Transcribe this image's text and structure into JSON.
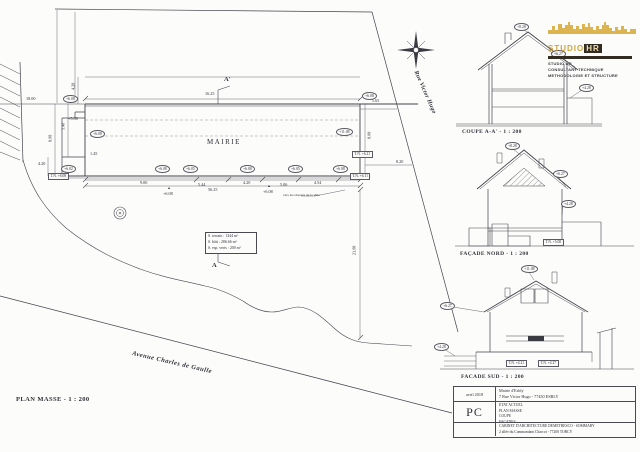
{
  "sheet": {
    "colors": {
      "paper": "#fcfcfa",
      "line": "#44444e",
      "logo_gold": "#d0a23c",
      "logo_dark": "#332c23"
    }
  },
  "titles": {
    "plan_masse": "PLAN MASSE - 1 : 200",
    "coupe": "COUPE A-A' - 1 : 200",
    "facade_nord": "FAÇADE NORD - 1 : 200",
    "facade_sud": "FACADE SUD - 1 : 200"
  },
  "plan": {
    "building_label": "MAIRIE",
    "surface_box": {
      "line1": "S. terrain : 1344 m²",
      "line2": "S. bâti : 286.66 m²",
      "line3": "S. esp. verts : 200 m²"
    }
  },
  "logo": {
    "brand_studio": "STUDIO",
    "brand_hr": "HR",
    "tagline1": "STUDIO HR",
    "tagline2": "CONSULTANT TECHNIQUE",
    "tagline3": "METHODOLOGIE ET STRUCTURE"
  },
  "titleblock": {
    "date": "avril 2018",
    "doc_type": "PC",
    "client_name": "Mairie d'Esbly",
    "client_address": "7 Rue Victor Hugo - 77450 ESBLY",
    "content1": "ETAT ACTUEL",
    "content2": "PLAN MASSE",
    "content3": "COUPE",
    "content4": "FACADES",
    "architect": "CABINET D'ARCHITECTURE DEMETRESCO - SOMMARY",
    "architect_address": "2 allée du Commandant Charcot - 77200 TORCY"
  },
  "annotations": [
    {
      "t": "16.25",
      "x": 205,
      "y": 92,
      "c": "dim",
      "n": "dim-label"
    },
    {
      "t": "56.25",
      "x": 208,
      "y": 188,
      "c": "dim",
      "n": "dim-label"
    },
    {
      "t": "18.00",
      "x": 26,
      "y": 97,
      "c": "dim",
      "n": "dim-label"
    },
    {
      "t": "4.28",
      "x": 70,
      "y": 84,
      "c": "dim rot90",
      "n": "dim-label"
    },
    {
      "t": "5.40",
      "x": 60,
      "y": 124,
      "c": "dim rot90",
      "n": "dim-label"
    },
    {
      "t": "8.08",
      "x": 47,
      "y": 136,
      "c": "dim rot90",
      "n": "dim-label"
    },
    {
      "t": "4.20",
      "x": 38,
      "y": 162,
      "c": "dim",
      "n": "dim-label"
    },
    {
      "t": "1.45",
      "x": 90,
      "y": 152,
      "c": "dim",
      "n": "dim-label"
    },
    {
      "t": "9.00",
      "x": 140,
      "y": 181,
      "c": "dim",
      "n": "dim-label"
    },
    {
      "t": "5.44",
      "x": 198,
      "y": 183,
      "c": "dim",
      "n": "dim-label"
    },
    {
      "t": "4.20",
      "x": 243,
      "y": 181,
      "c": "dim",
      "n": "dim-label"
    },
    {
      "t": "5.06",
      "x": 280,
      "y": 183,
      "c": "dim",
      "n": "dim-label"
    },
    {
      "t": "4.54",
      "x": 314,
      "y": 181,
      "c": "dim",
      "n": "dim-label"
    },
    {
      "t": "5.65",
      "x": 372,
      "y": 99,
      "c": "dim",
      "n": "dim-label"
    },
    {
      "t": "8.08",
      "x": 366,
      "y": 133,
      "c": "dim rot90",
      "n": "dim-label"
    },
    {
      "t": "8.20",
      "x": 396,
      "y": 160,
      "c": "dim",
      "n": "dim-label"
    },
    {
      "t": "21.08",
      "x": 350,
      "y": 248,
      "c": "dim rot90",
      "n": "dim-label"
    },
    {
      "t": "+5.08",
      "x": 68,
      "y": 117,
      "c": "dim",
      "n": "level-label"
    },
    {
      "t": "+6.08",
      "x": 163,
      "y": 192,
      "c": "dim",
      "n": "level-label"
    },
    {
      "t": "+6.08",
      "x": 263,
      "y": 190,
      "c": "dim",
      "n": "level-label"
    },
    {
      "t": "▴",
      "x": 168,
      "y": 186,
      "c": "dim",
      "n": "threshold-marker"
    },
    {
      "t": "▴",
      "x": 268,
      "y": 184,
      "c": "dim",
      "n": "threshold-marker"
    },
    {
      "t": "+6.08",
      "x": 63,
      "y": 95,
      "c": "bub",
      "n": "level-bubble"
    },
    {
      "t": "+6.08",
      "x": 90,
      "y": 130,
      "c": "bub",
      "n": "level-bubble"
    },
    {
      "t": "+6.02",
      "x": 61,
      "y": 165,
      "c": "bub",
      "n": "level-bubble"
    },
    {
      "t": "+6.08",
      "x": 155,
      "y": 165,
      "c": "bub",
      "n": "level-bubble"
    },
    {
      "t": "+6.05",
      "x": 183,
      "y": 165,
      "c": "bub",
      "n": "level-bubble"
    },
    {
      "t": "+6.08",
      "x": 240,
      "y": 165,
      "c": "bub",
      "n": "level-bubble"
    },
    {
      "t": "+6.05",
      "x": 288,
      "y": 165,
      "c": "bub",
      "n": "level-bubble"
    },
    {
      "t": "+6.08",
      "x": 333,
      "y": 165,
      "c": "bub",
      "n": "level-bubble"
    },
    {
      "t": "+11.08",
      "x": 336,
      "y": 128,
      "c": "bub",
      "n": "level-bubble"
    },
    {
      "t": "+6.08",
      "x": 362,
      "y": 92,
      "c": "bub",
      "n": "level-bubble"
    },
    {
      "t": "T.N. +6.08",
      "x": 48,
      "y": 173,
      "c": "tnb",
      "n": "ground-level-box"
    },
    {
      "t": "T.N. +6.21",
      "x": 352,
      "y": 151,
      "c": "tnb",
      "n": "ground-level-box"
    },
    {
      "t": "T.N. +6.11",
      "x": 350,
      "y": 173,
      "c": "tnb",
      "n": "ground-level-box"
    },
    {
      "t": "A'",
      "x": 224,
      "y": 76,
      "c": "mk",
      "n": "section-marker-a-prime"
    },
    {
      "t": "A",
      "x": 212,
      "y": 262,
      "c": "mk",
      "n": "section-marker-a"
    },
    {
      "t": "Rue Victor Hugo",
      "x": 418,
      "y": 70,
      "r": 66,
      "c": "street",
      "n": "street-label-rue-victor-hugo"
    },
    {
      "t": "Avenue Charles de Gaulle",
      "x": 133,
      "y": 350,
      "r": 13,
      "c": "street avenue",
      "n": "street-label-avenue-charles-de-gaulle"
    },
    {
      "t": "vers les réseaux de la ville",
      "x": 283,
      "y": 194,
      "c": "tiny",
      "n": "note-network"
    },
    {
      "t": "+8.28",
      "x": 514,
      "y": 23,
      "c": "bub",
      "n": "level-bubble"
    },
    {
      "t": "+6.27",
      "x": 551,
      "y": 50,
      "c": "bub",
      "n": "level-bubble"
    },
    {
      "t": "+4.28",
      "x": 579,
      "y": 84,
      "c": "bub",
      "n": "level-bubble"
    },
    {
      "t": "+8.28",
      "x": 505,
      "y": 142,
      "c": "bub",
      "n": "level-bubble"
    },
    {
      "t": "+6.27",
      "x": 553,
      "y": 170,
      "c": "bub",
      "n": "level-bubble"
    },
    {
      "t": "+4.28",
      "x": 561,
      "y": 200,
      "c": "bub",
      "n": "level-bubble"
    },
    {
      "t": "T.N. +5.08",
      "x": 543,
      "y": 239,
      "c": "tnb",
      "n": "ground-level-box"
    },
    {
      "t": "+11.08",
      "x": 521,
      "y": 265,
      "c": "bub",
      "n": "level-bubble"
    },
    {
      "t": "+6.27",
      "x": 440,
      "y": 302,
      "c": "bub",
      "n": "level-bubble"
    },
    {
      "t": "+4.28",
      "x": 434,
      "y": 343,
      "c": "bub",
      "n": "level-bubble"
    },
    {
      "t": "T.N. +4.21",
      "x": 506,
      "y": 360,
      "c": "tnb",
      "n": "ground-level-box"
    },
    {
      "t": "T.N. +4.27",
      "x": 538,
      "y": 360,
      "c": "tnb",
      "n": "ground-level-box"
    }
  ]
}
